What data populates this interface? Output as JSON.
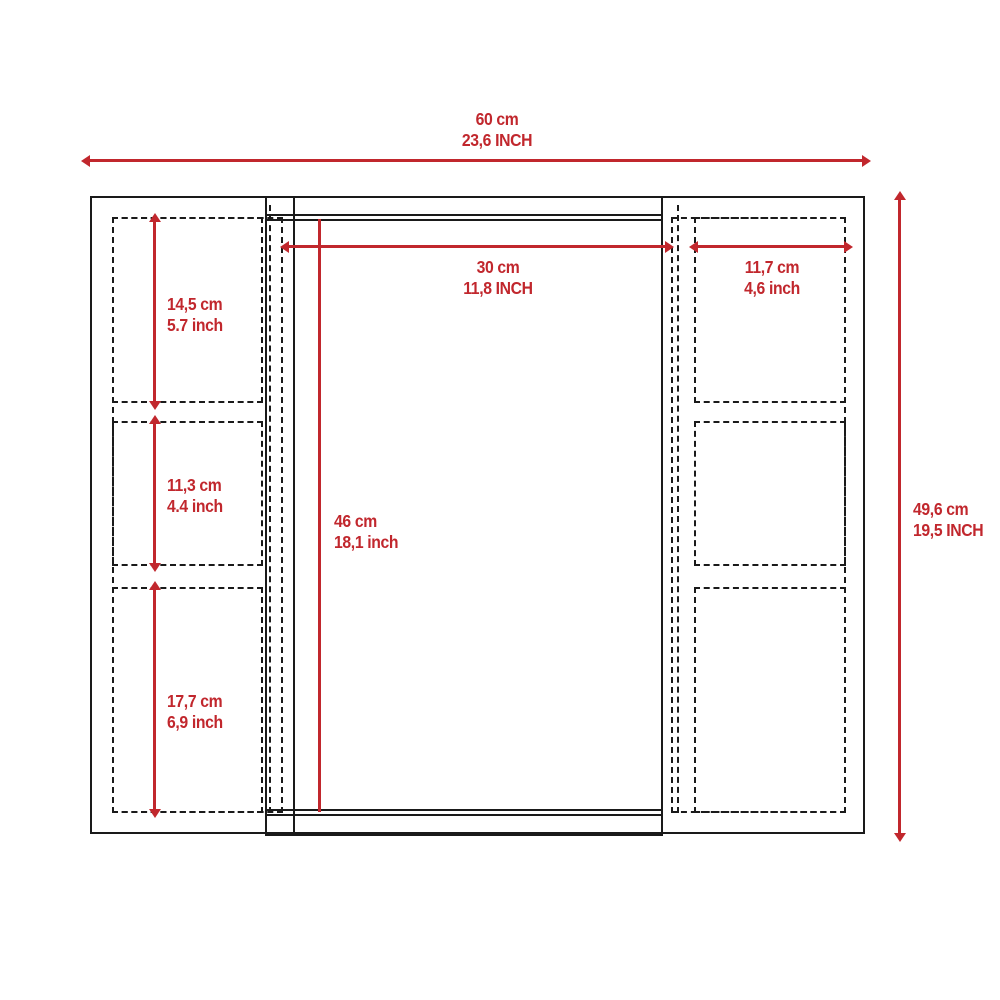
{
  "diagram_title": "cabinet-dimension-diagram",
  "colors": {
    "dimension_color": "#c1272d",
    "outline_color": "#1a1a1a"
  },
  "dimensions": {
    "overall_width": {
      "cm": "60 cm",
      "inch": "23,6 INCH"
    },
    "overall_height": {
      "cm": "49,6 cm",
      "inch": "19,5 INCH"
    },
    "mirror_width": {
      "cm": "30 cm",
      "inch": "11,8 INCH"
    },
    "mirror_height": {
      "cm": "46 cm",
      "inch": "18,1 inch"
    },
    "side_shelf_width": {
      "cm": "11,7 cm",
      "inch": "4,6 inch"
    },
    "left_shelf_top": {
      "cm": "14,5 cm",
      "inch": "5.7 inch"
    },
    "left_shelf_middle": {
      "cm": "11,3 cm",
      "inch": "4.4 inch"
    },
    "left_shelf_bottom": {
      "cm": "17,7 cm",
      "inch": "6,9 inch"
    }
  }
}
